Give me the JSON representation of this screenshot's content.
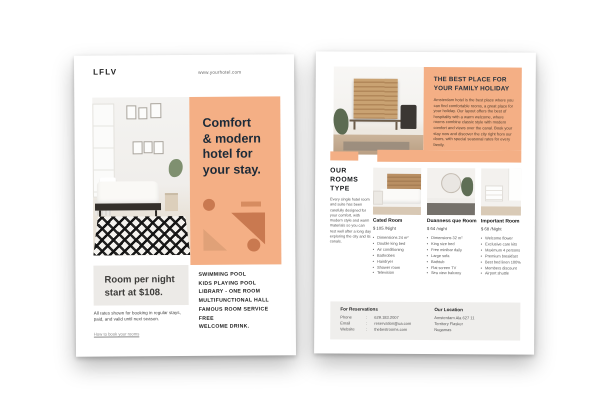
{
  "left_flyer": {
    "logo": "LFLV",
    "website": "www.yourhotel.com",
    "headline_lines": [
      "Comfort",
      "& modern",
      "hotel for",
      "your stay."
    ],
    "price_lines": [
      "Room per night",
      "start at $108."
    ],
    "note": "All rates shown for booking in regular stays, paid, and valid until next season.",
    "note_link": "How to book your rooms",
    "amenities": [
      "SWIMMING POOL",
      "KIDS PLAYING POOL",
      "LIBRARY - ONE ROOM",
      "MULTIFUNCTIONAL HALL",
      "FAMOUS ROOM SERVICE",
      "FREE",
      "WELCOME DRINK."
    ],
    "colors": {
      "accent": "#F4AF85",
      "shape_dark": "#C97950",
      "shape_light": "#E0A178",
      "headline": "#1C2A38",
      "price_box": "#ECEAE7"
    }
  },
  "right_flyer": {
    "hero": {
      "title_lines": [
        "THE BEST PLACE FOR",
        "YOUR FAMILY HOLIDAY"
      ],
      "body": "Amsterdam hotel is the best place where you can find comfortable rooms, a great place for your holiday. Our layout offers the best of hospitality with a warm welcome, where rooms combine classic style with modern comfort and views over the canal. Book your stay now and discover the city right from our doors, with special seasonal rates for every family."
    },
    "rooms_heading_lines": [
      "OUR",
      "ROOMS",
      "TYPE"
    ],
    "rooms_intro": "Every single hotel room and suite has been carefully designed for your comfort, with modern style and warm materials so you can rest well after a long day exploring the city and its canals.",
    "bullet": "•",
    "rooms": [
      {
        "name": "Cated Room",
        "price": "$ 105 /Night",
        "features": [
          "Dimensions 24 m²",
          "Double king bed",
          "Air conditioning",
          "Bathrobes",
          "Hairdryer",
          "Shower room",
          "Television"
        ]
      },
      {
        "name": "Duanness que Room",
        "price": "$ 64 /night",
        "features": [
          "Dimensions 32 m²",
          "King size bed",
          "Free minibar daily",
          "Large sofa",
          "Bathtub",
          "Flat screen TV",
          "Sea view balcony"
        ]
      },
      {
        "name": "Important Room",
        "price": "$ 68 /Night",
        "features": [
          "Welcome flower",
          "Exclusive care kits",
          "Maximum 4 persons",
          "Premium breakfast",
          "Best bed linen 100%",
          "Members discount",
          "Airport shuttle"
        ]
      }
    ],
    "footer": {
      "reservations_title": "For Reservations",
      "reservations_rows": [
        {
          "label": "Phone",
          "value": "629.183.2007"
        },
        {
          "label": "Email",
          "value": "reservation@ua.com"
        },
        {
          "label": "Website",
          "value": "thebestrooms.com"
        }
      ],
      "location_title": "Our Location",
      "location_lines": [
        "Amsterdam Ala 627 11",
        "Territory Flasker",
        "Nugamas"
      ]
    }
  }
}
